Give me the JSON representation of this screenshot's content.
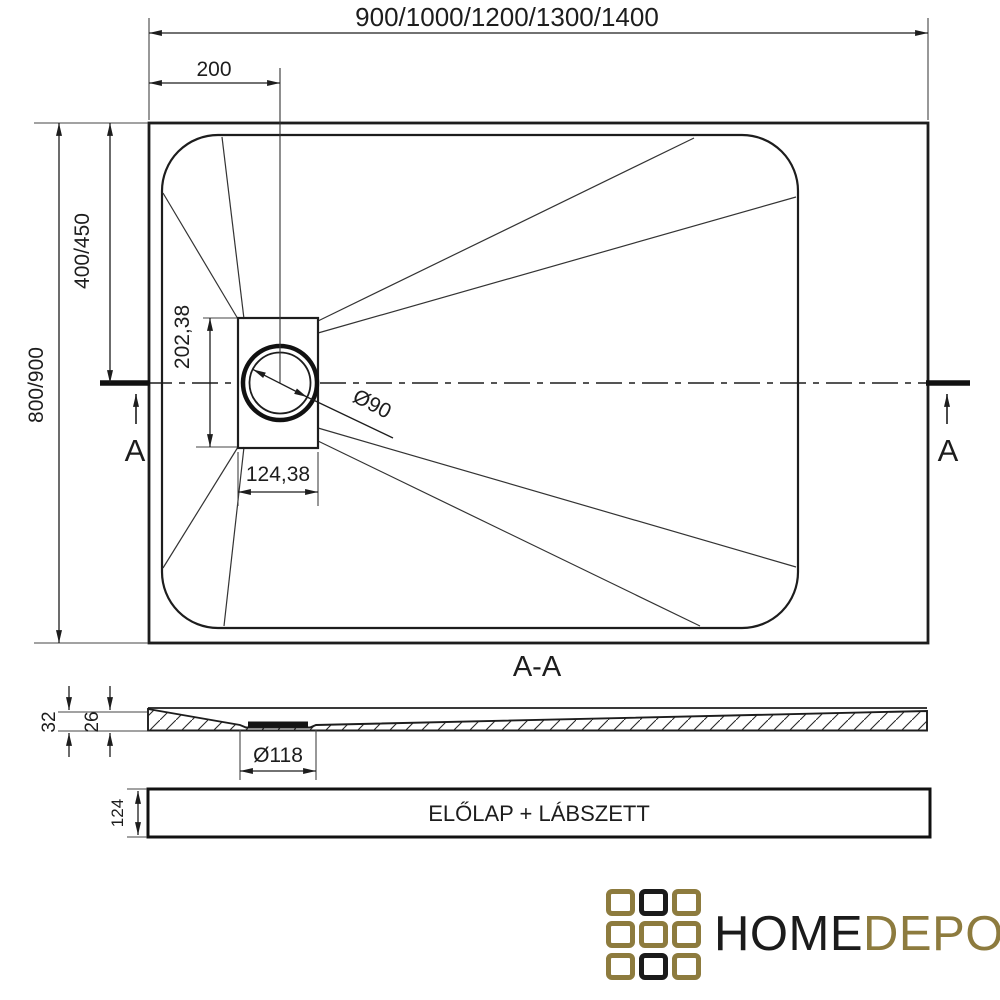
{
  "plan": {
    "dim_length": "900/1000/1200/1300/1400",
    "dim_offset": "200",
    "dim_width_total": "800/900",
    "dim_width_half": "400/450",
    "dim_drain_unit_height": "202,38",
    "dim_drain_unit_width": "124,38",
    "dim_drain_diameter": "Ø90",
    "section_marker_left": "A",
    "section_marker_right": "A"
  },
  "section": {
    "title": "A-A",
    "dim_edge_thickness": "32",
    "dim_inner_thickness": "26",
    "dim_recess_diameter": "Ø118"
  },
  "panel": {
    "label": "ELŐLAP + LÁBSZETT",
    "dim_height": "124"
  },
  "logo": {
    "word_primary": "HOME",
    "word_secondary": "DEPO",
    "color_black": "#1B1B1B",
    "color_gold": "#8D7B3E",
    "grid_pattern": [
      "gold",
      "black",
      "gold",
      "gold",
      "gold",
      "gold",
      "gold",
      "black",
      "gold"
    ]
  }
}
